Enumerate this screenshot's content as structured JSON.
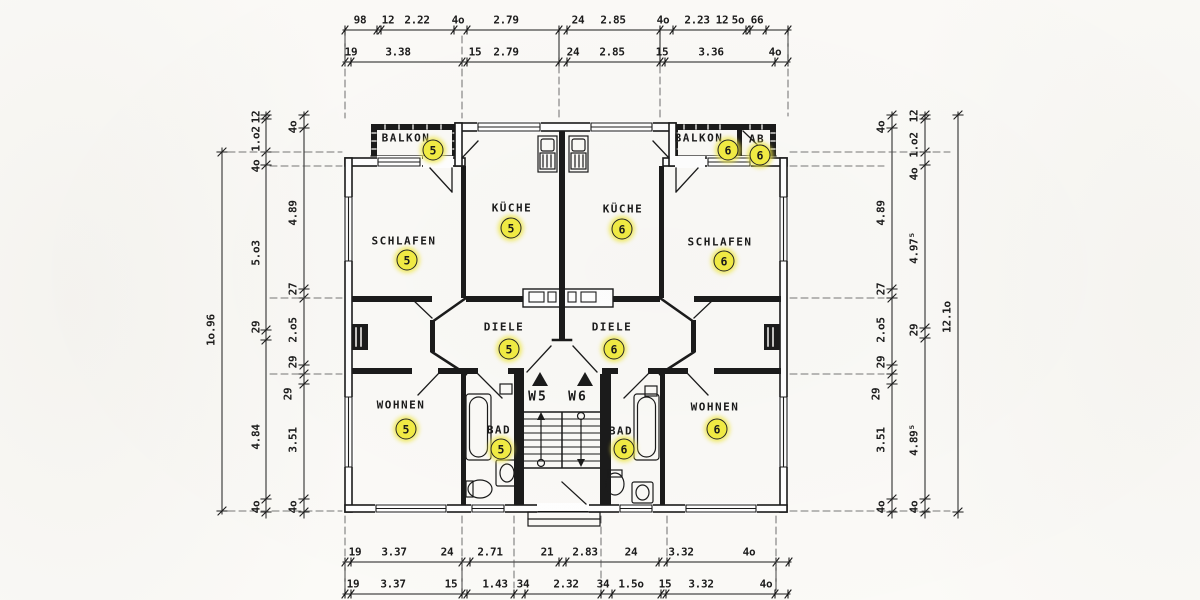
{
  "colors": {
    "ink": "#1b1b1b",
    "paper": "#fbfaf7",
    "highlight": "#f2ec44"
  },
  "rooms": {
    "balkon5": {
      "label": "BALKON",
      "unit": "5"
    },
    "balkon6": {
      "label": "BALKON",
      "unit": "6"
    },
    "ab6": {
      "label": "AB",
      "unit": "6"
    },
    "schlafen5": {
      "label": "SCHLAFEN",
      "unit": "5"
    },
    "schlafen6": {
      "label": "SCHLAFEN",
      "unit": "6"
    },
    "kueche5": {
      "label": "KÜCHE",
      "unit": "5"
    },
    "kueche6": {
      "label": "KÜCHE",
      "unit": "6"
    },
    "diele5": {
      "label": "DIELE",
      "unit": "5"
    },
    "diele6": {
      "label": "DIELE",
      "unit": "6"
    },
    "wohnen5": {
      "label": "WOHNEN",
      "unit": "5"
    },
    "wohnen6": {
      "label": "WOHNEN",
      "unit": "6"
    },
    "bad5": {
      "label": "BAD",
      "unit": "5"
    },
    "bad6": {
      "label": "BAD",
      "unit": "6"
    }
  },
  "stair": {
    "w5": "W5",
    "w6": "W6"
  },
  "dims": {
    "top1": [
      "98",
      "12",
      "2.22",
      "4o",
      "2.79",
      "24",
      "2.85",
      "4o",
      "2.23",
      "12",
      "5o",
      "66"
    ],
    "top2": [
      "19",
      "3.38",
      "15",
      "2.79",
      "24",
      "2.85",
      "15",
      "3.36",
      "4o"
    ],
    "bottom1": [
      "19",
      "3.37",
      "24",
      "2.71",
      "21",
      "2.83",
      "24",
      "3.32",
      "4o"
    ],
    "bottom2": [
      "19",
      "3.37",
      "15",
      "1.43",
      "34",
      "2.32",
      "34",
      "1.5o",
      "15",
      "3.32",
      "4o"
    ],
    "left_outer": [
      "1o.96"
    ],
    "left_mid": [
      "12",
      "1.o2",
      "4o",
      "5.o3",
      "29",
      "4.84",
      "4o"
    ],
    "left_inner": [
      "4o",
      "4.89",
      "27",
      "2.o5",
      "29",
      "29",
      "3.51",
      "4o"
    ],
    "right_inner": [
      "4o",
      "4.89",
      "27",
      "2.o5",
      "29",
      "29",
      "3.51",
      "4o"
    ],
    "right_mid": [
      "12",
      "1.o2",
      "4o",
      "4.97⁵",
      "29",
      "4.89⁵",
      "4o"
    ],
    "right_outer": [
      "12.1o"
    ]
  }
}
